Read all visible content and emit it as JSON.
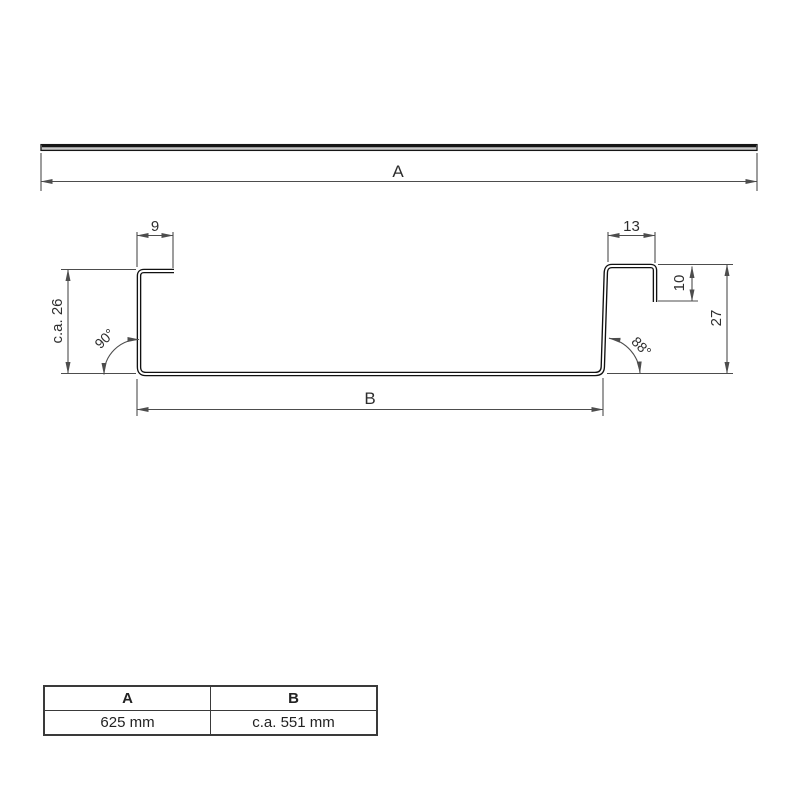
{
  "labels": {
    "overall_width": "A",
    "base_width": "B",
    "left_flange_width": "9",
    "right_flange_width": "13",
    "hook_depth": "10",
    "right_height": "27",
    "left_height": "c.a. 26",
    "left_angle": "90°",
    "right_angle": "88°"
  },
  "table": {
    "headers": [
      "A",
      "B"
    ],
    "values": [
      "625 mm",
      "c.a. 551 mm"
    ]
  },
  "colors": {
    "profile_line": "#111111",
    "dimension_line": "#4d4d4d",
    "text": "#2e2e2e",
    "sheet_fill": "#c9c9c9"
  }
}
